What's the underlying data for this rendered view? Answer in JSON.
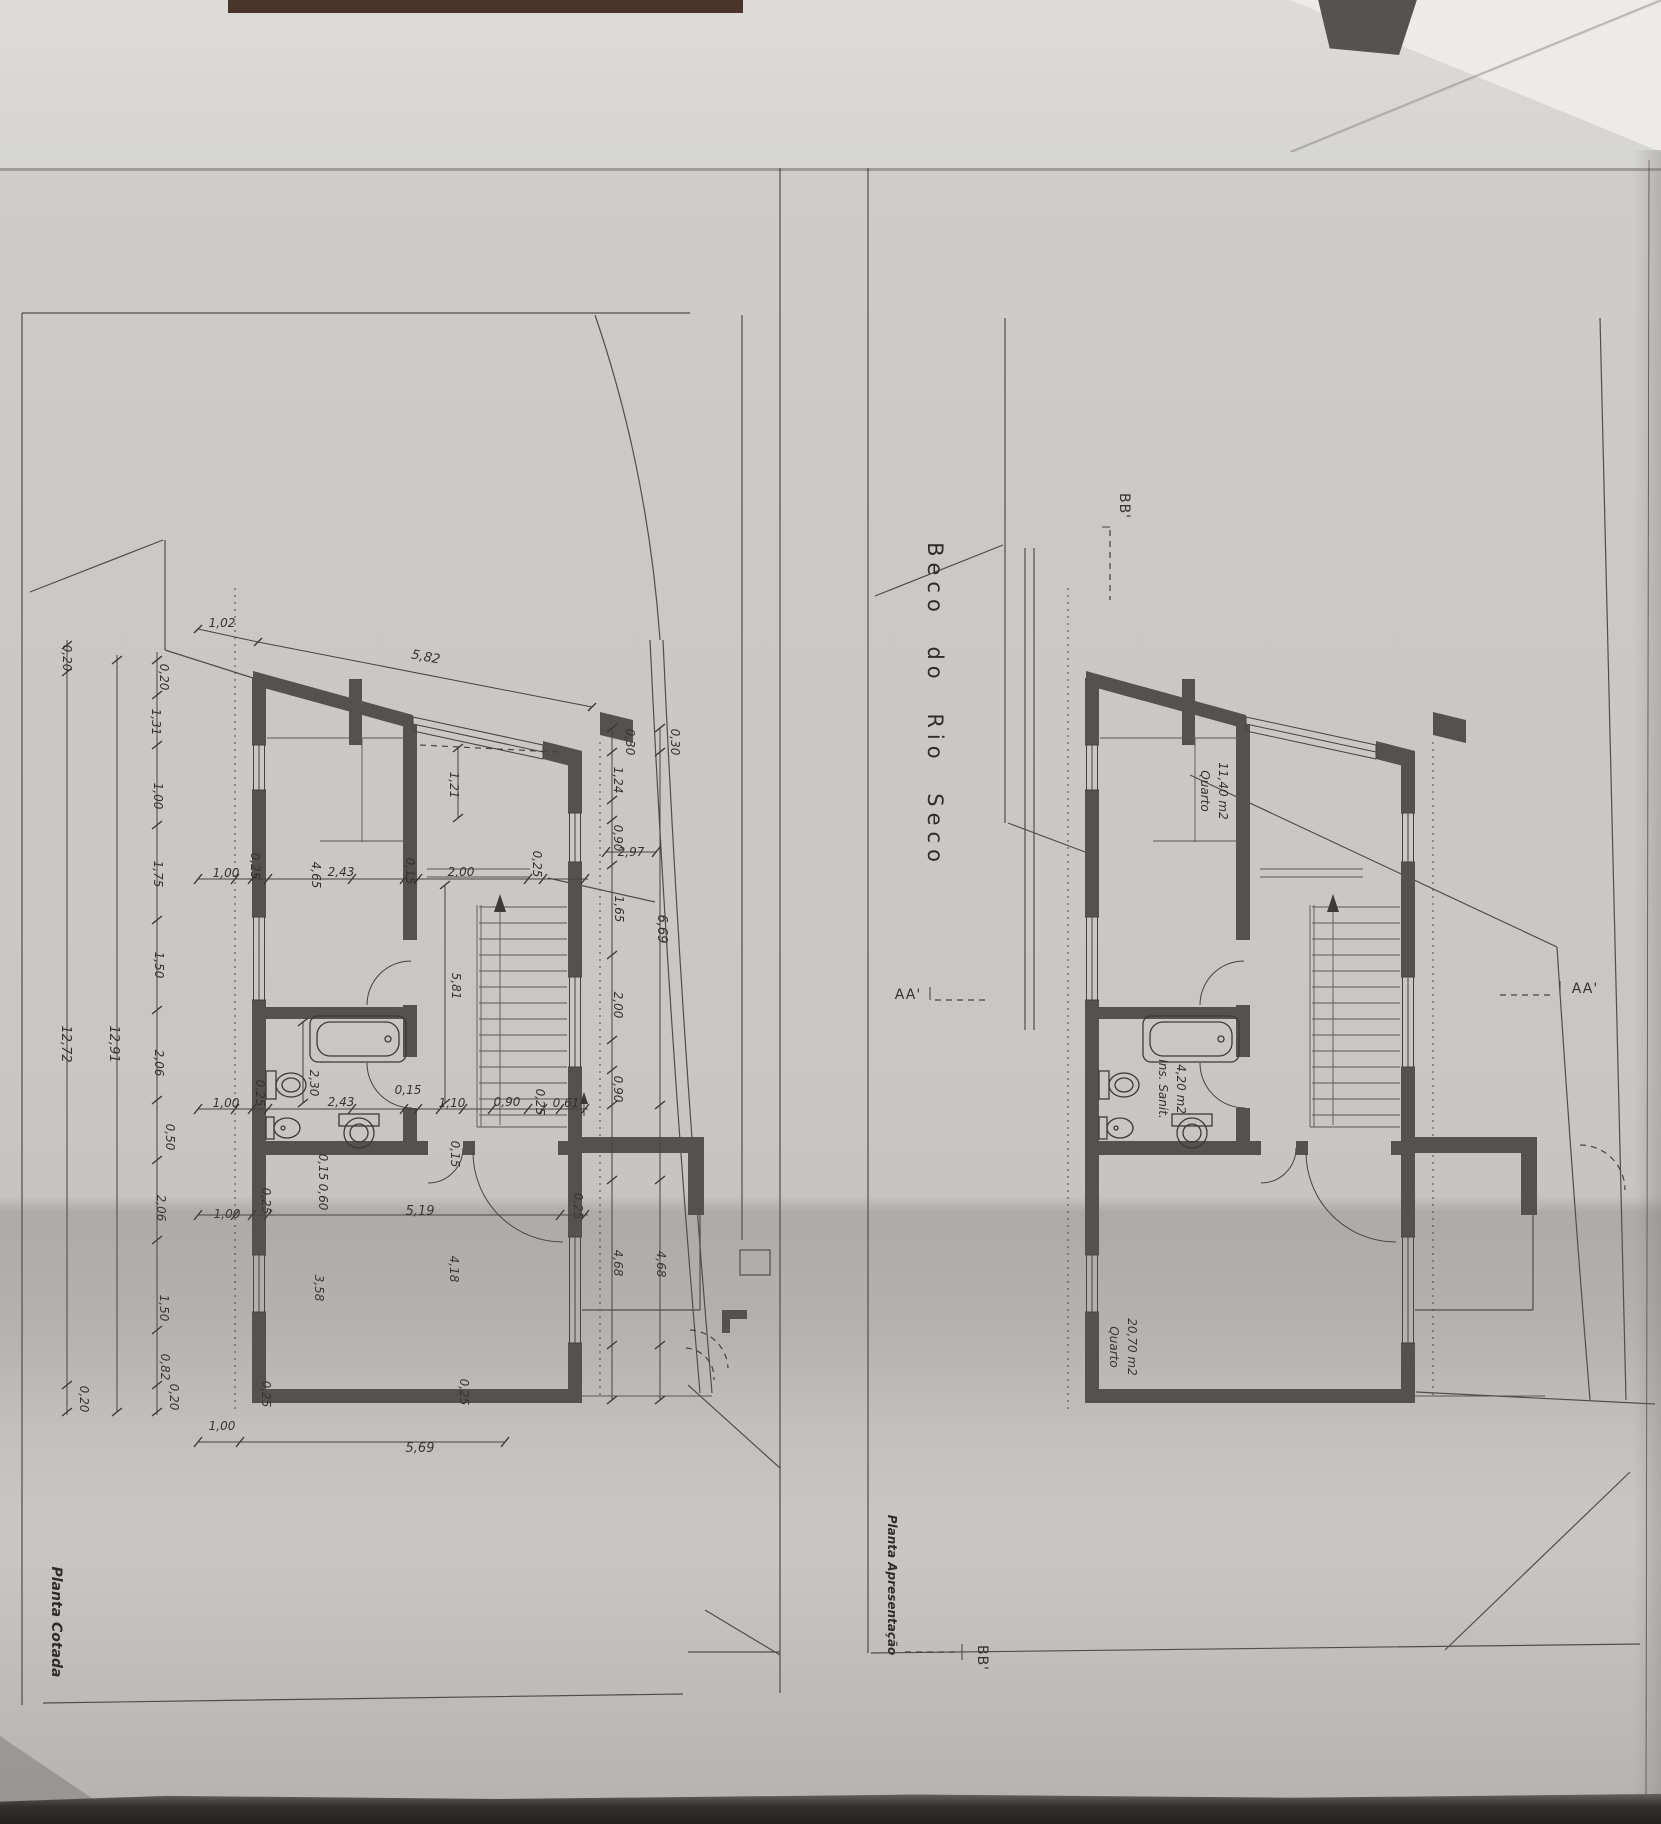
{
  "drawing": {
    "street_name": "Beco do Rio Seco",
    "panels": [
      {
        "title": "Planta Cotada"
      },
      {
        "title": "Planta Apresentação"
      }
    ],
    "rooms": [
      {
        "name": "Quarto",
        "area": "11,40 m2"
      },
      {
        "name": "Ins. Sanit.",
        "area": "4,20 m2"
      },
      {
        "name": "Quarto",
        "area": "20,70 m2"
      }
    ],
    "section_markers": [
      "BB'",
      "AA'",
      "AA'",
      "BB'"
    ]
  },
  "labels": [
    {
      "n": "street-name",
      "t": "Beco do Rio Seco",
      "x": 928,
      "y": 705,
      "r": 90,
      "c": "street"
    },
    {
      "n": "title-planta-cotada",
      "t": "Planta Cotada",
      "x": 52,
      "y": 1622,
      "r": 90,
      "c": "title1"
    },
    {
      "n": "title-planta-apresentacao",
      "t": "Planta Apresentação",
      "x": 888,
      "y": 1585,
      "r": 90,
      "c": "title2"
    },
    {
      "n": "marker-bb-top",
      "t": "BB'",
      "x": 1120,
      "y": 506,
      "r": 90,
      "c": "marker"
    },
    {
      "n": "marker-aa-left",
      "t": "AA'",
      "x": 908,
      "y": 999,
      "r": 0,
      "c": "marker"
    },
    {
      "n": "marker-aa-right",
      "t": "AA'",
      "x": 1585,
      "y": 993,
      "r": 0,
      "c": "marker"
    },
    {
      "n": "marker-bb-bottom",
      "t": "BB'",
      "x": 978,
      "y": 1658,
      "r": 90,
      "c": "marker"
    },
    {
      "n": "room-quarto1-name",
      "t": "Quarto",
      "x": 1201,
      "y": 791,
      "r": 90,
      "c": "room"
    },
    {
      "n": "room-quarto1-area",
      "t": "11,40 m2",
      "x": 1219,
      "y": 791,
      "r": 90,
      "c": "room"
    },
    {
      "n": "room-sanit-name",
      "t": "Ins. Sanit.",
      "x": 1159,
      "y": 1089,
      "r": 90,
      "c": "room"
    },
    {
      "n": "room-sanit-area",
      "t": "4,20 m2",
      "x": 1177,
      "y": 1089,
      "r": 90,
      "c": "room"
    },
    {
      "n": "room-quarto2-name",
      "t": "Quarto",
      "x": 1110,
      "y": 1347,
      "r": 90,
      "c": "room"
    },
    {
      "n": "room-quarto2-area",
      "t": "20,70 m2",
      "x": 1128,
      "y": 1347,
      "r": 90,
      "c": "room"
    },
    {
      "t": "0,20",
      "x": 63,
      "y": 658,
      "r": 90,
      "c": "d"
    },
    {
      "t": "12,72",
      "x": 62,
      "y": 1044,
      "r": 90,
      "c": "db"
    },
    {
      "t": "0,20",
      "x": 80,
      "y": 1399,
      "r": 90,
      "c": "d"
    },
    {
      "t": "12,91",
      "x": 110,
      "y": 1044,
      "r": 90,
      "c": "db"
    },
    {
      "t": "0,20",
      "x": 160,
      "y": 677,
      "r": 90,
      "c": "d"
    },
    {
      "t": "1,31",
      "x": 152,
      "y": 722,
      "r": 90,
      "c": "d"
    },
    {
      "t": "1,00",
      "x": 154,
      "y": 796,
      "r": 90,
      "c": "d"
    },
    {
      "t": "1,75",
      "x": 154,
      "y": 874,
      "r": 90,
      "c": "d"
    },
    {
      "t": "1,50",
      "x": 155,
      "y": 965,
      "r": 90,
      "c": "d"
    },
    {
      "t": "2,06",
      "x": 155,
      "y": 1063,
      "r": 90,
      "c": "d"
    },
    {
      "t": "0,50",
      "x": 166,
      "y": 1137,
      "r": 90,
      "c": "d"
    },
    {
      "t": "2,06",
      "x": 157,
      "y": 1208,
      "r": 90,
      "c": "d"
    },
    {
      "t": "1,50",
      "x": 160,
      "y": 1308,
      "r": 90,
      "c": "d"
    },
    {
      "t": "0,82",
      "x": 161,
      "y": 1367,
      "r": 90,
      "c": "d"
    },
    {
      "t": "0,20",
      "x": 170,
      "y": 1397,
      "r": 90,
      "c": "d"
    },
    {
      "t": "1,02",
      "x": 222,
      "y": 627,
      "r": 0,
      "c": "d"
    },
    {
      "t": "5,82",
      "x": 425,
      "y": 661,
      "r": 11,
      "c": "db"
    },
    {
      "t": "1,00",
      "x": 226,
      "y": 877,
      "r": 0,
      "c": "d"
    },
    {
      "t": "0,25",
      "x": 251,
      "y": 866,
      "r": 90,
      "c": "d"
    },
    {
      "t": "4,65",
      "x": 312,
      "y": 875,
      "r": 90,
      "c": "d"
    },
    {
      "t": "2,43",
      "x": 341,
      "y": 876,
      "r": 0,
      "c": "d"
    },
    {
      "t": "0,15",
      "x": 406,
      "y": 871,
      "r": 90,
      "c": "d"
    },
    {
      "t": "2,00",
      "x": 461,
      "y": 876,
      "r": 0,
      "c": "d"
    },
    {
      "t": "0,25",
      "x": 533,
      "y": 864,
      "r": 90,
      "c": "d"
    },
    {
      "t": "2,97",
      "x": 631,
      "y": 856,
      "r": 0,
      "c": "d"
    },
    {
      "t": "1,21",
      "x": 450,
      "y": 785,
      "r": 90,
      "c": "d"
    },
    {
      "t": "5,81",
      "x": 452,
      "y": 986,
      "r": 90,
      "c": "d"
    },
    {
      "t": "1,00",
      "x": 226,
      "y": 1107,
      "r": 0,
      "c": "d"
    },
    {
      "t": "0,25",
      "x": 256,
      "y": 1093,
      "r": 90,
      "c": "d"
    },
    {
      "t": "2,30",
      "x": 310,
      "y": 1083,
      "r": 90,
      "c": "d"
    },
    {
      "t": "2,43",
      "x": 341,
      "y": 1106,
      "r": 0,
      "c": "d"
    },
    {
      "t": "0,15",
      "x": 408,
      "y": 1094,
      "r": 0,
      "c": "d"
    },
    {
      "t": "1,10",
      "x": 452,
      "y": 1107,
      "r": 0,
      "c": "d"
    },
    {
      "t": "0,90",
      "x": 507,
      "y": 1106,
      "r": 0,
      "c": "d"
    },
    {
      "t": "0,25",
      "x": 536,
      "y": 1102,
      "r": 90,
      "c": "d"
    },
    {
      "t": "0,61",
      "x": 566,
      "y": 1107,
      "r": 0,
      "c": "d"
    },
    {
      "t": "0,15",
      "x": 451,
      "y": 1154,
      "r": 90,
      "c": "d"
    },
    {
      "t": "0,15",
      "x": 319,
      "y": 1167,
      "r": 90,
      "c": "d"
    },
    {
      "t": "0,60",
      "x": 319,
      "y": 1197,
      "r": 90,
      "c": "d"
    },
    {
      "t": "0,30",
      "x": 626,
      "y": 742,
      "r": 90,
      "c": "d"
    },
    {
      "t": "0,30",
      "x": 671,
      "y": 742,
      "r": 90,
      "c": "d"
    },
    {
      "t": "1,24",
      "x": 614,
      "y": 780,
      "r": 90,
      "c": "d"
    },
    {
      "t": "0,90",
      "x": 614,
      "y": 838,
      "r": 90,
      "c": "d"
    },
    {
      "t": "1,65",
      "x": 615,
      "y": 909,
      "r": 90,
      "c": "d"
    },
    {
      "t": "6,69",
      "x": 658,
      "y": 929,
      "r": 90,
      "c": "db"
    },
    {
      "t": "2,00",
      "x": 614,
      "y": 1005,
      "r": 90,
      "c": "d"
    },
    {
      "t": "0,90",
      "x": 614,
      "y": 1089,
      "r": 90,
      "c": "d"
    },
    {
      "t": "4,68",
      "x": 614,
      "y": 1263,
      "r": 90,
      "c": "d"
    },
    {
      "t": "4,68",
      "x": 657,
      "y": 1264,
      "r": 90,
      "c": "d"
    },
    {
      "t": "0,25",
      "x": 262,
      "y": 1201,
      "r": 90,
      "c": "d"
    },
    {
      "t": "5,19",
      "x": 420,
      "y": 1215,
      "r": 0,
      "c": "db"
    },
    {
      "t": "0,25",
      "x": 574,
      "y": 1206,
      "r": 90,
      "c": "d"
    },
    {
      "t": "1,00",
      "x": 227,
      "y": 1218,
      "r": 0,
      "c": "d"
    },
    {
      "t": "3,58",
      "x": 315,
      "y": 1288,
      "r": 90,
      "c": "d"
    },
    {
      "t": "4,18",
      "x": 450,
      "y": 1269,
      "r": 90,
      "c": "d"
    },
    {
      "t": "0,25",
      "x": 262,
      "y": 1394,
      "r": 90,
      "c": "d"
    },
    {
      "t": "0,25",
      "x": 460,
      "y": 1392,
      "r": 90,
      "c": "d"
    },
    {
      "t": "5,69",
      "x": 420,
      "y": 1452,
      "r": 0,
      "c": "db"
    },
    {
      "t": "1,00",
      "x": 222,
      "y": 1430,
      "r": 0,
      "c": "d"
    }
  ]
}
